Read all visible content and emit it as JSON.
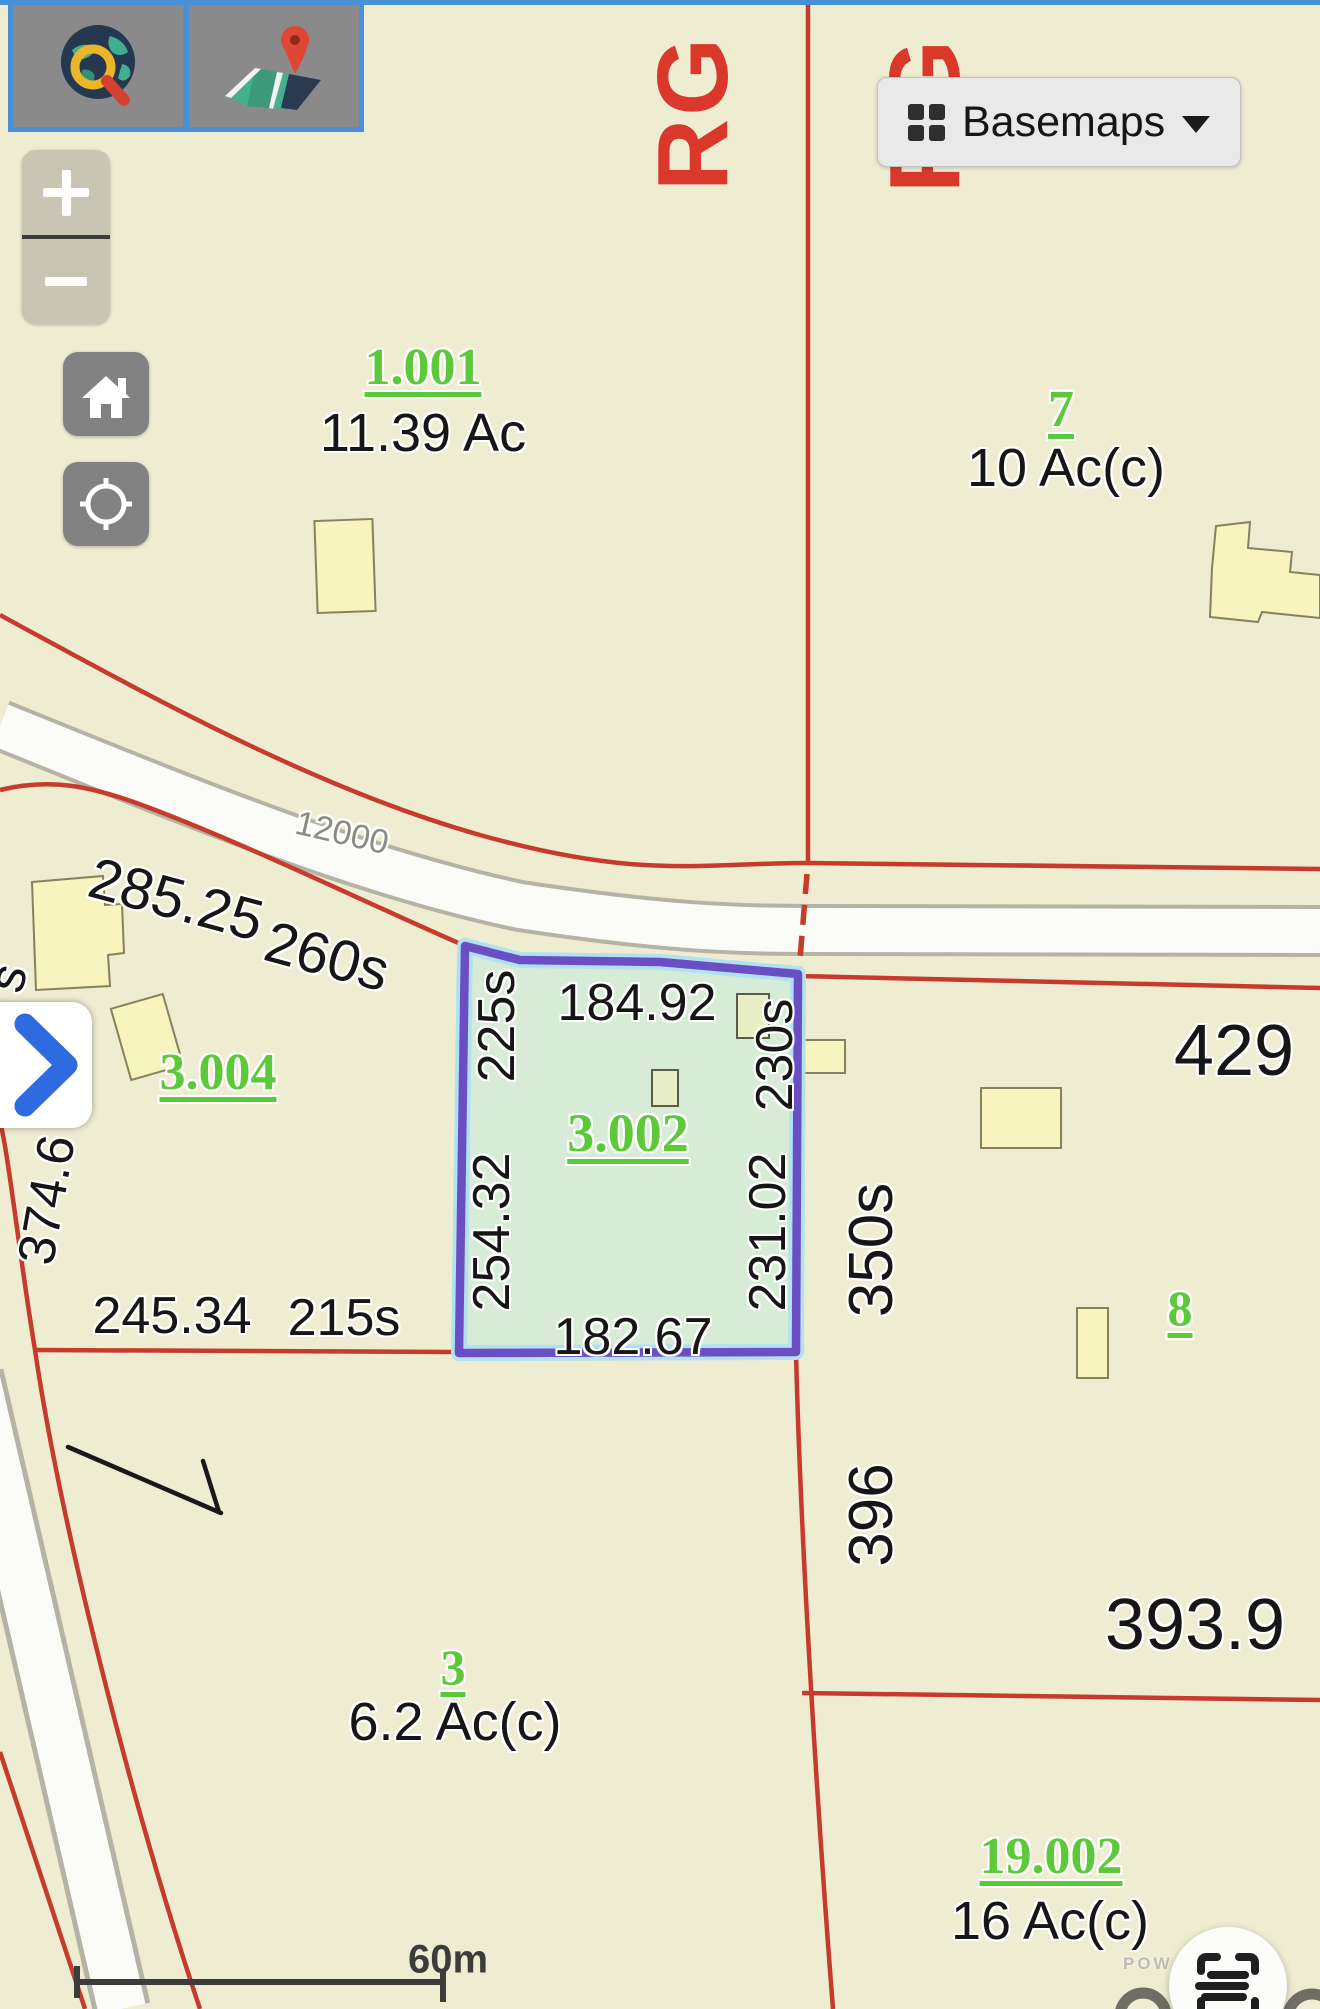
{
  "ui": {
    "top_bar_color": "#4a90d8",
    "toolbar": {
      "search_tile_icon": "globe-search-icon",
      "locator_tile_icon": "map-pin-icon"
    },
    "zoom_control": {
      "zoom_in": "+",
      "zoom_out": "−"
    },
    "basemaps_button": {
      "label": "Basemaps",
      "icon": "grid-icon",
      "caret": "chevron-down"
    },
    "panel_toggle_icon": "chevron-right-icon",
    "home_icon": "home-icon",
    "locate_icon": "locate-icon",
    "fab_icon": "scan-text-icon",
    "scale_bar": {
      "label": "60m"
    },
    "attribution": {
      "powered_by_visible": "POW"
    }
  },
  "map": {
    "colors": {
      "background": "#eeecd1",
      "parcel_line": "#c63b2c",
      "road_fill": "#fbfbf8",
      "road_name_text": "#d9382b",
      "parcel_id_text": "#5cc938",
      "selected_fill": "#d7ebd7",
      "selected_border": "#6c4ec4",
      "building_fill": "#f8f4bd"
    },
    "road_names": [
      {
        "text": "RG"
      },
      {
        "text": "RG"
      }
    ],
    "street_label": {
      "text": "12000"
    },
    "parcels": [
      {
        "id": "1.001",
        "area": "11.39 Ac"
      },
      {
        "id": "7",
        "area": "10 Ac(c)"
      },
      {
        "id": "3.004"
      },
      {
        "id": "3.002"
      },
      {
        "id": "8"
      },
      {
        "id": "3",
        "area": "6.2 Ac(c)"
      },
      {
        "id": "19.002",
        "area": "16 Ac(c)"
      }
    ],
    "dimensions": [
      {
        "text": "285.25"
      },
      {
        "text": "260s"
      },
      {
        "text": "374.6"
      },
      {
        "text": "s"
      },
      {
        "text": "225s"
      },
      {
        "text": "184.92"
      },
      {
        "text": "230s"
      },
      {
        "text": "254.32"
      },
      {
        "text": "231.02"
      },
      {
        "text": "182.67"
      },
      {
        "text": "245.34"
      },
      {
        "text": "215s"
      },
      {
        "text": "429"
      },
      {
        "text": "350s"
      },
      {
        "text": "396"
      },
      {
        "text": "393.9"
      }
    ]
  }
}
